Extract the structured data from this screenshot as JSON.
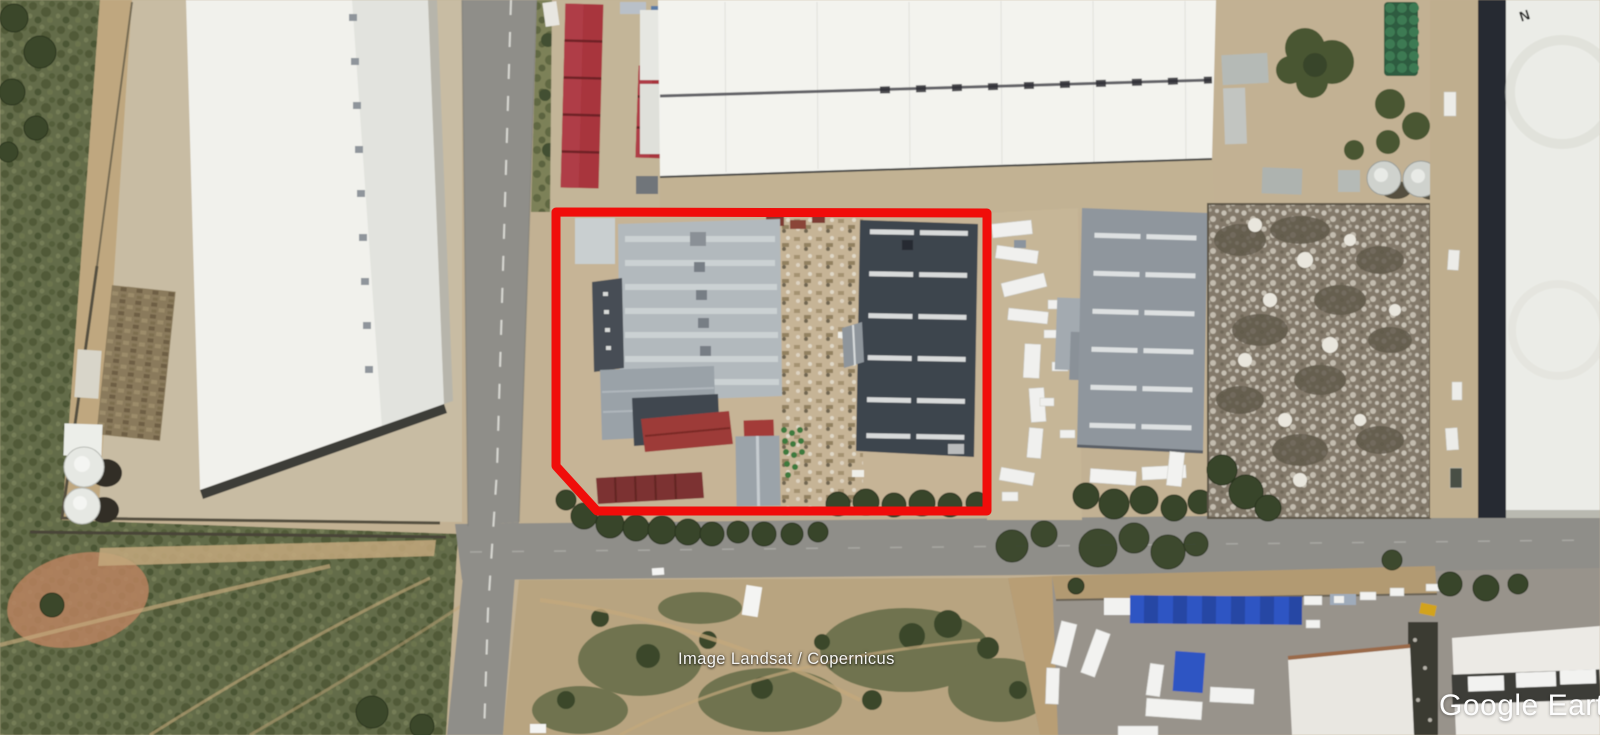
{
  "app": {
    "name": "Google Earth",
    "view": "satellite-imagery"
  },
  "map": {
    "attribution": "Image Landsat / Copernicus",
    "watermark": "Google Earth",
    "roof_marking_n": "N",
    "description": "Aerial view of an industrial area with warehouses, roads, yards and a red property boundary overlay"
  },
  "overlay": {
    "property_boundary": {
      "color": "#f00d0a",
      "points": "556,212 987,213 987,511 597,511 556,466",
      "stroke_width": "9"
    }
  },
  "colors": {
    "boundary_red": "#f00d0a",
    "canopy_blue": "#2f55c3",
    "red_roof": "#a8363e",
    "dark_roof": "#3d444d",
    "asphalt": "#8f8e89",
    "scrub_green": "#636c48",
    "dirt_tan": "#c2b193",
    "white_roof": "#f1f1ec"
  }
}
